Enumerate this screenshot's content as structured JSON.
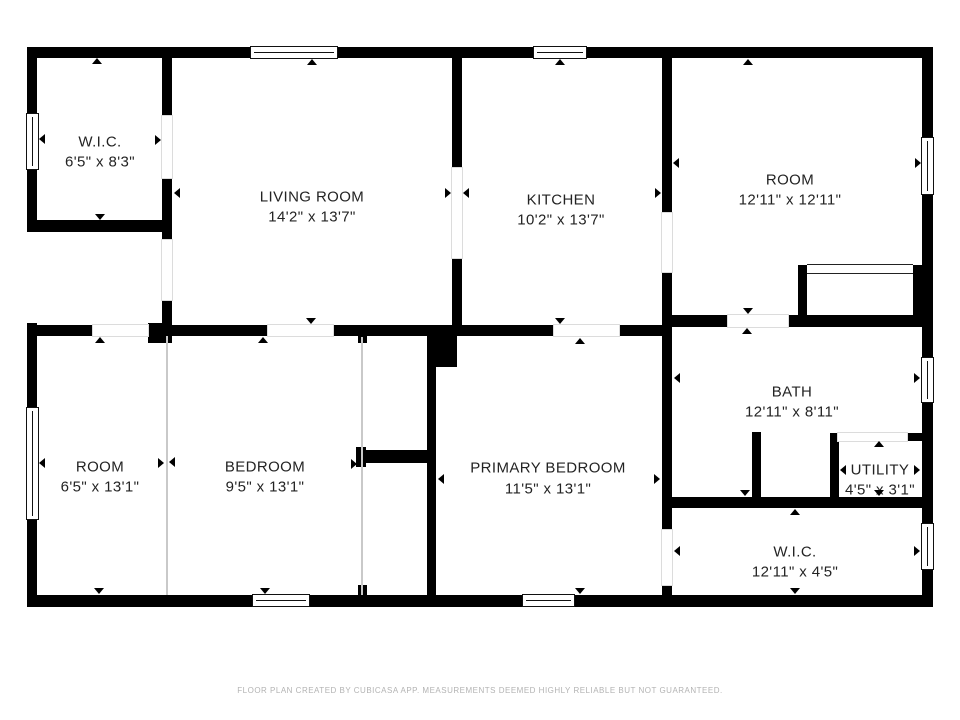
{
  "footer": {
    "disclaimer": "FLOOR PLAN CREATED BY CUBICASA APP. MEASUREMENTS DEEMED HIGHLY RELIABLE BUT NOT GUARANTEED."
  },
  "colors": {
    "wall": "#000000",
    "label_text": "#232323",
    "footer_text": "#b3b3b3",
    "open_boundary": "#c9c9c9",
    "background": "#ffffff"
  },
  "rooms": [
    {
      "id": "wic-top-left",
      "name": "W.I.C.",
      "dims": "6'5\" x 8'3\"",
      "cx": 100,
      "name_y": 142,
      "dims_y": 162,
      "arrows": [
        {
          "x": 97,
          "y": 58,
          "d": "up"
        },
        {
          "x": 100,
          "y": 220,
          "d": "down"
        },
        {
          "x": 39,
          "y": 139,
          "d": "left"
        },
        {
          "x": 161,
          "y": 140,
          "d": "right"
        }
      ]
    },
    {
      "id": "living-room",
      "name": "LIVING ROOM",
      "dims": "14'2\" x 13'7\"",
      "cx": 312,
      "name_y": 197,
      "dims_y": 217,
      "arrows": [
        {
          "x": 312,
          "y": 59,
          "d": "up"
        },
        {
          "x": 311,
          "y": 324,
          "d": "down"
        },
        {
          "x": 174,
          "y": 193,
          "d": "left"
        },
        {
          "x": 451,
          "y": 193,
          "d": "right"
        }
      ]
    },
    {
      "id": "kitchen",
      "name": "KITCHEN",
      "dims": "10'2\" x 13'7\"",
      "cx": 561,
      "name_y": 200,
      "dims_y": 220,
      "arrows": [
        {
          "x": 560,
          "y": 59,
          "d": "up"
        },
        {
          "x": 560,
          "y": 324,
          "d": "down"
        },
        {
          "x": 463,
          "y": 193,
          "d": "left"
        },
        {
          "x": 661,
          "y": 193,
          "d": "right"
        }
      ]
    },
    {
      "id": "room-top-right",
      "name": "ROOM",
      "dims": "12'11\" x 12'11\"",
      "cx": 790,
      "name_y": 180,
      "dims_y": 200,
      "arrows": [
        {
          "x": 748,
          "y": 59,
          "d": "up"
        },
        {
          "x": 748,
          "y": 314,
          "d": "down"
        },
        {
          "x": 673,
          "y": 163,
          "d": "left"
        },
        {
          "x": 921,
          "y": 163,
          "d": "right"
        }
      ]
    },
    {
      "id": "room-bottom-left",
      "name": "ROOM",
      "dims": "6'5\" x 13'1\"",
      "cx": 100,
      "name_y": 467,
      "dims_y": 487,
      "arrows": [
        {
          "x": 100,
          "y": 337,
          "d": "up"
        },
        {
          "x": 99,
          "y": 594,
          "d": "down"
        },
        {
          "x": 39,
          "y": 463,
          "d": "left"
        },
        {
          "x": 164,
          "y": 463,
          "d": "right"
        }
      ]
    },
    {
      "id": "bedroom",
      "name": "BEDROOM",
      "dims": "9'5\" x 13'1\"",
      "cx": 265,
      "name_y": 467,
      "dims_y": 487,
      "arrows": [
        {
          "x": 263,
          "y": 337,
          "d": "up"
        },
        {
          "x": 265,
          "y": 594,
          "d": "down"
        },
        {
          "x": 169,
          "y": 462,
          "d": "left"
        },
        {
          "x": 357,
          "y": 464,
          "d": "right"
        }
      ]
    },
    {
      "id": "primary-bedroom",
      "name": "PRIMARY BEDROOM",
      "dims": "11'5\" x 13'1\"",
      "cx": 548,
      "name_y": 468,
      "dims_y": 489,
      "arrows": [
        {
          "x": 580,
          "y": 338,
          "d": "up"
        },
        {
          "x": 580,
          "y": 594,
          "d": "down"
        },
        {
          "x": 438,
          "y": 479,
          "d": "left"
        },
        {
          "x": 660,
          "y": 479,
          "d": "right"
        }
      ]
    },
    {
      "id": "bath",
      "name": "BATH",
      "dims": "12'11\" x 8'11\"",
      "cx": 792,
      "name_y": 392,
      "dims_y": 412,
      "arrows": [
        {
          "x": 747,
          "y": 328,
          "d": "up"
        },
        {
          "x": 745,
          "y": 496,
          "d": "down"
        },
        {
          "x": 674,
          "y": 378,
          "d": "left"
        },
        {
          "x": 920,
          "y": 378,
          "d": "right"
        }
      ]
    },
    {
      "id": "utility",
      "name": "UTILITY",
      "dims": "4'5\" x 3'1\"",
      "cx": 880,
      "name_y": 470,
      "dims_y": 490,
      "arrows": [
        {
          "x": 879,
          "y": 441,
          "d": "up"
        },
        {
          "x": 879,
          "y": 496,
          "d": "down"
        },
        {
          "x": 840,
          "y": 470,
          "d": "left"
        },
        {
          "x": 920,
          "y": 470,
          "d": "right"
        }
      ]
    },
    {
      "id": "wic-bottom-right",
      "name": "W.I.C.",
      "dims": "12'11\" x 4'5\"",
      "cx": 795,
      "name_y": 552,
      "dims_y": 572,
      "arrows": [
        {
          "x": 795,
          "y": 509,
          "d": "up"
        },
        {
          "x": 795,
          "y": 594,
          "d": "down"
        },
        {
          "x": 674,
          "y": 551,
          "d": "left"
        },
        {
          "x": 920,
          "y": 551,
          "d": "right"
        }
      ]
    }
  ],
  "walls": [
    {
      "x": 27,
      "y": 47,
      "w": 223,
      "h": 11
    },
    {
      "x": 338,
      "y": 47,
      "w": 195,
      "h": 11
    },
    {
      "x": 587,
      "y": 47,
      "w": 346,
      "h": 11
    },
    {
      "x": 27,
      "y": 47,
      "w": 10,
      "h": 66
    },
    {
      "x": 27,
      "y": 170,
      "w": 10,
      "h": 62
    },
    {
      "x": 27,
      "y": 323,
      "w": 10,
      "h": 84
    },
    {
      "x": 27,
      "y": 520,
      "w": 10,
      "h": 87
    },
    {
      "x": 922,
      "y": 47,
      "w": 11,
      "h": 90
    },
    {
      "x": 922,
      "y": 195,
      "w": 11,
      "h": 162
    },
    {
      "x": 922,
      "y": 403,
      "w": 11,
      "h": 120
    },
    {
      "x": 922,
      "y": 570,
      "w": 11,
      "h": 37
    },
    {
      "x": 27,
      "y": 595,
      "w": 225,
      "h": 12
    },
    {
      "x": 310,
      "y": 595,
      "w": 212,
      "h": 12
    },
    {
      "x": 575,
      "y": 595,
      "w": 358,
      "h": 12
    },
    {
      "x": 27,
      "y": 220,
      "w": 145,
      "h": 12
    },
    {
      "x": 162,
      "y": 58,
      "w": 10,
      "h": 58
    },
    {
      "x": 162,
      "y": 178,
      "w": 10,
      "h": 62
    },
    {
      "x": 162,
      "y": 300,
      "w": 10,
      "h": 36
    },
    {
      "x": 27,
      "y": 325,
      "w": 66,
      "h": 11
    },
    {
      "x": 148,
      "y": 323,
      "w": 24,
      "h": 20
    },
    {
      "x": 172,
      "y": 325,
      "w": 96,
      "h": 11
    },
    {
      "x": 333,
      "y": 325,
      "w": 94,
      "h": 11
    },
    {
      "x": 358,
      "y": 336,
      "w": 9,
      "h": 7
    },
    {
      "x": 427,
      "y": 325,
      "w": 30,
      "h": 42
    },
    {
      "x": 457,
      "y": 325,
      "w": 97,
      "h": 11
    },
    {
      "x": 619,
      "y": 325,
      "w": 53,
      "h": 11
    },
    {
      "x": 452,
      "y": 58,
      "w": 10,
      "h": 110
    },
    {
      "x": 452,
      "y": 258,
      "w": 10,
      "h": 67
    },
    {
      "x": 662,
      "y": 58,
      "w": 10,
      "h": 155
    },
    {
      "x": 662,
      "y": 272,
      "w": 10,
      "h": 258
    },
    {
      "x": 662,
      "y": 585,
      "w": 10,
      "h": 22
    },
    {
      "x": 672,
      "y": 315,
      "w": 56,
      "h": 12
    },
    {
      "x": 788,
      "y": 315,
      "w": 145,
      "h": 12
    },
    {
      "x": 798,
      "y": 265,
      "w": 9,
      "h": 55
    },
    {
      "x": 913,
      "y": 265,
      "w": 12,
      "h": 55
    },
    {
      "x": 752,
      "y": 432,
      "w": 9,
      "h": 66
    },
    {
      "x": 662,
      "y": 497,
      "w": 260,
      "h": 11
    },
    {
      "x": 830,
      "y": 433,
      "w": 9,
      "h": 64
    },
    {
      "x": 907,
      "y": 433,
      "w": 15,
      "h": 8
    },
    {
      "x": 427,
      "y": 367,
      "w": 9,
      "h": 230
    },
    {
      "x": 360,
      "y": 450,
      "w": 70,
      "h": 13
    },
    {
      "x": 356,
      "y": 447,
      "w": 10,
      "h": 20
    },
    {
      "x": 358,
      "y": 585,
      "w": 9,
      "h": 10
    }
  ],
  "doors": [
    {
      "x": 162,
      "y": 116,
      "w": 10,
      "h": 62
    },
    {
      "x": 162,
      "y": 240,
      "w": 10,
      "h": 60
    },
    {
      "x": 93,
      "y": 325,
      "w": 55,
      "h": 11
    },
    {
      "x": 268,
      "y": 325,
      "w": 65,
      "h": 11
    },
    {
      "x": 554,
      "y": 325,
      "w": 65,
      "h": 11
    },
    {
      "x": 452,
      "y": 168,
      "w": 10,
      "h": 90
    },
    {
      "x": 662,
      "y": 213,
      "w": 10,
      "h": 59
    },
    {
      "x": 728,
      "y": 315,
      "w": 60,
      "h": 12
    },
    {
      "x": 838,
      "y": 433,
      "w": 69,
      "h": 8
    },
    {
      "x": 662,
      "y": 530,
      "w": 10,
      "h": 55
    }
  ],
  "windows": [
    {
      "x": 250,
      "y": 46,
      "w": 88,
      "h": 13,
      "o": "h"
    },
    {
      "x": 533,
      "y": 46,
      "w": 54,
      "h": 13,
      "o": "h"
    },
    {
      "x": 26,
      "y": 113,
      "w": 13,
      "h": 57,
      "o": "v"
    },
    {
      "x": 26,
      "y": 407,
      "w": 13,
      "h": 113,
      "o": "v"
    },
    {
      "x": 921,
      "y": 137,
      "w": 13,
      "h": 58,
      "o": "v"
    },
    {
      "x": 921,
      "y": 357,
      "w": 13,
      "h": 46,
      "o": "v"
    },
    {
      "x": 921,
      "y": 523,
      "w": 13,
      "h": 47,
      "o": "v"
    },
    {
      "x": 252,
      "y": 594,
      "w": 58,
      "h": 13,
      "o": "h"
    },
    {
      "x": 522,
      "y": 594,
      "w": 53,
      "h": 13,
      "o": "h"
    }
  ],
  "open_boundaries": [
    {
      "x": 166,
      "y": 336,
      "w": 2,
      "h": 259
    },
    {
      "x": 361,
      "y": 337,
      "w": 2,
      "h": 258
    }
  ],
  "sliders": [
    {
      "x": 807,
      "y": 264,
      "w": 106,
      "h": 10
    }
  ]
}
